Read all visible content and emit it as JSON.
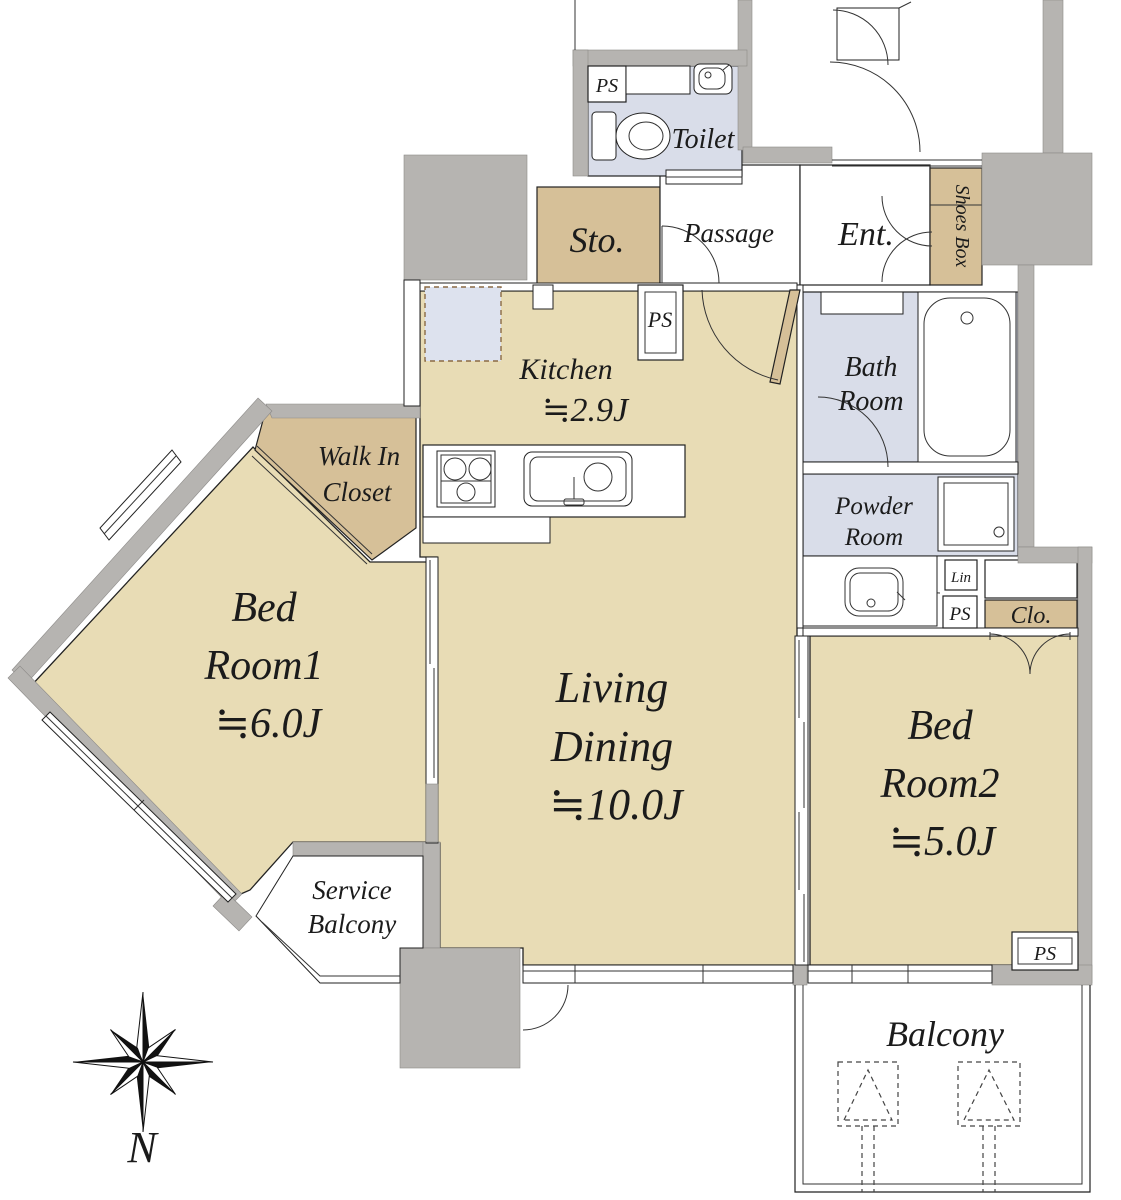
{
  "colors": {
    "floor_tan": "#e8dcb5",
    "closet_tan": "#d6c098",
    "wet_blue": "#d9dde9",
    "wall_gray": "#b6b4b1",
    "fridge_blue": "#dde2ee",
    "line_dark": "#222222"
  },
  "labels": {
    "toilet": "Toilet",
    "passage": "Passage",
    "entrance": "Ent.",
    "storage": "Sto.",
    "shoes_box": "Shoes Box",
    "ps": "PS",
    "lin": "Lin",
    "closet": "Clo.",
    "kitchen": {
      "name": "Kitchen",
      "area": "≒2.9J"
    },
    "bath": {
      "line1": "Bath",
      "line2": "Room"
    },
    "powder": {
      "line1": "Powder",
      "line2": "Room"
    },
    "wic": {
      "line1": "Walk In",
      "line2": "Closet"
    },
    "living": {
      "line1": "Living",
      "line2": "Dining",
      "area": "≒10.0J"
    },
    "bedroom1": {
      "line1": "Bed",
      "line2": "Room1",
      "area": "≒6.0J"
    },
    "bedroom2": {
      "line1": "Bed",
      "line2": "Room2",
      "area": "≒5.0J"
    },
    "service_balcony": {
      "line1": "Service",
      "line2": "Balcony"
    },
    "balcony": "Balcony",
    "compass_north": "N"
  }
}
